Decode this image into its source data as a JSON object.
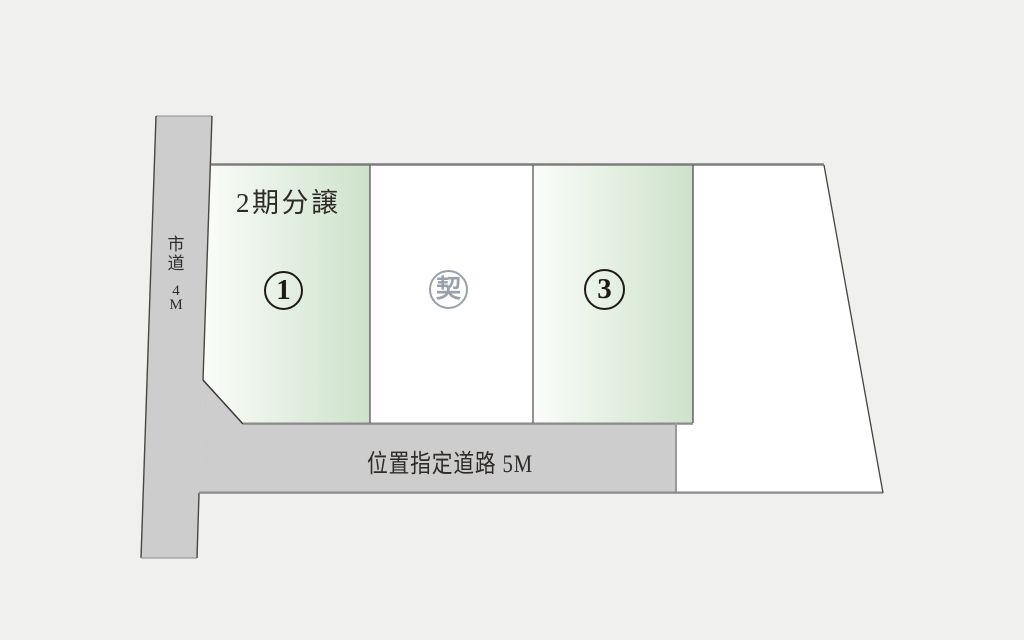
{
  "map": {
    "phase_label": "2期分譲",
    "lots": [
      {
        "symbol": "1"
      },
      {
        "symbol": "契"
      },
      {
        "symbol": "3"
      }
    ],
    "roads": {
      "city_road": {
        "label": "市道 4M",
        "chars": [
          "市",
          "道",
          "4",
          "M"
        ]
      },
      "designated_road": {
        "label": "位置指定道路 5M"
      }
    },
    "colors": {
      "background": "#f0f0ef",
      "road_fill": "#cdcdcd",
      "lot_green_start": "#fbfdfa",
      "lot_green_end": "#cde2ca",
      "lot_white": "#ffffff",
      "contracted_gray": "#97a1ab",
      "outline_dark": "#46423e",
      "outline_gray": "#8a8a8a",
      "text_dark": "#2e2a26",
      "badge_dark": "#201a14"
    }
  }
}
